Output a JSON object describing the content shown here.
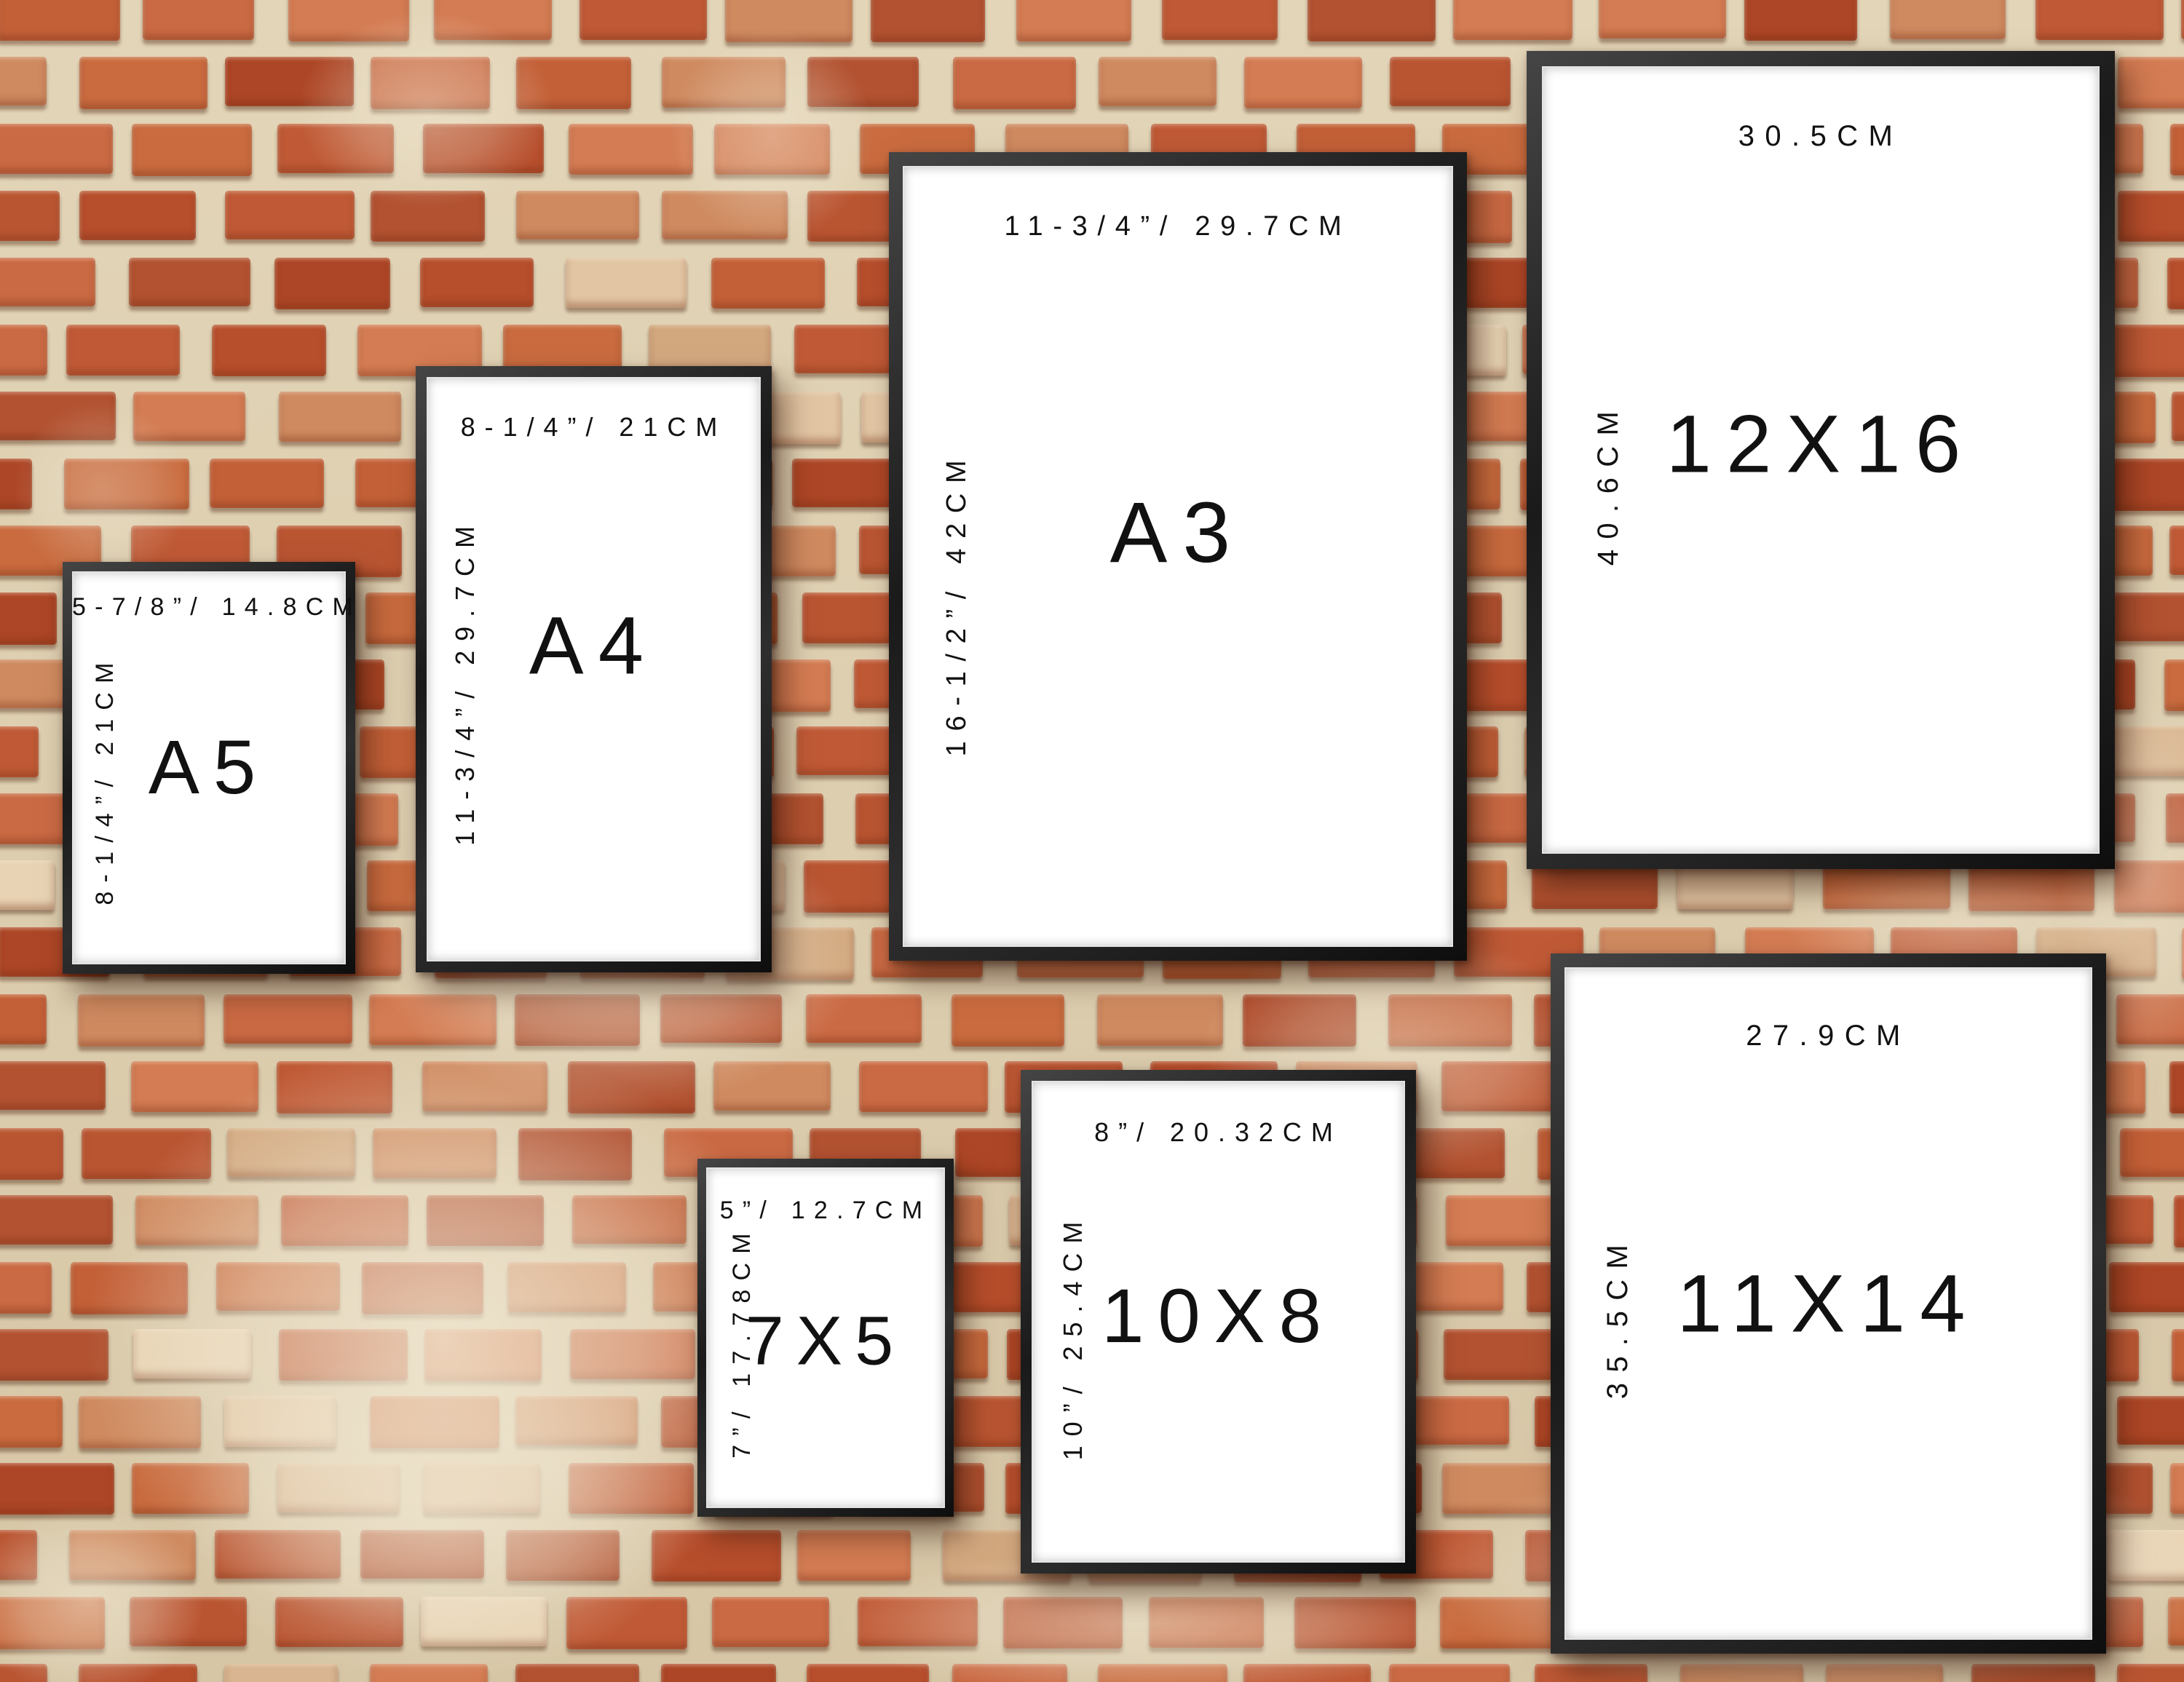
{
  "frames": [
    {
      "id": "a5",
      "name": "A5",
      "top_label": "5-7/8”/ 14.8CM",
      "side_label": "8-1/4”/ 21CM"
    },
    {
      "id": "a4",
      "name": "A4",
      "top_label": "8-1/4”/ 21CM",
      "side_label": "11-3/4”/ 29.7CM"
    },
    {
      "id": "a3",
      "name": "A3",
      "top_label": "11-3/4”/ 29.7CM",
      "side_label": "16-1/2”/ 42CM"
    },
    {
      "id": "12x16",
      "name": "12X16",
      "top_label": "30.5CM",
      "side_label": "40.6CM"
    },
    {
      "id": "7x5",
      "name": "7X5",
      "top_label": "5”/ 12.7CM",
      "side_label": "7”/ 17.78CM"
    },
    {
      "id": "10x8",
      "name": "10X8",
      "top_label": "8”/ 20.32CM",
      "side_label": "10”/ 25.4CM"
    },
    {
      "id": "11x14",
      "name": "11X14",
      "top_label": "27.9CM",
      "side_label": "35.5CM"
    }
  ],
  "colors": {
    "frame_molding": "#1f1f1f",
    "paper": "#ffffff",
    "label_text": "#111111",
    "mortar": "#ddcfb2",
    "whitewash": "#f2e9d4",
    "brick_palette": [
      "#c05a36",
      "#b74e2c",
      "#ca6a44",
      "#d47c53",
      "#ad4626",
      "#c36038",
      "#cf8a60",
      "#ba5532",
      "#c96b3f",
      "#b25231"
    ],
    "brick_light_palette": [
      "#e2c6a4",
      "#d9b691",
      "#e8d3b4",
      "#d2a87f"
    ]
  }
}
